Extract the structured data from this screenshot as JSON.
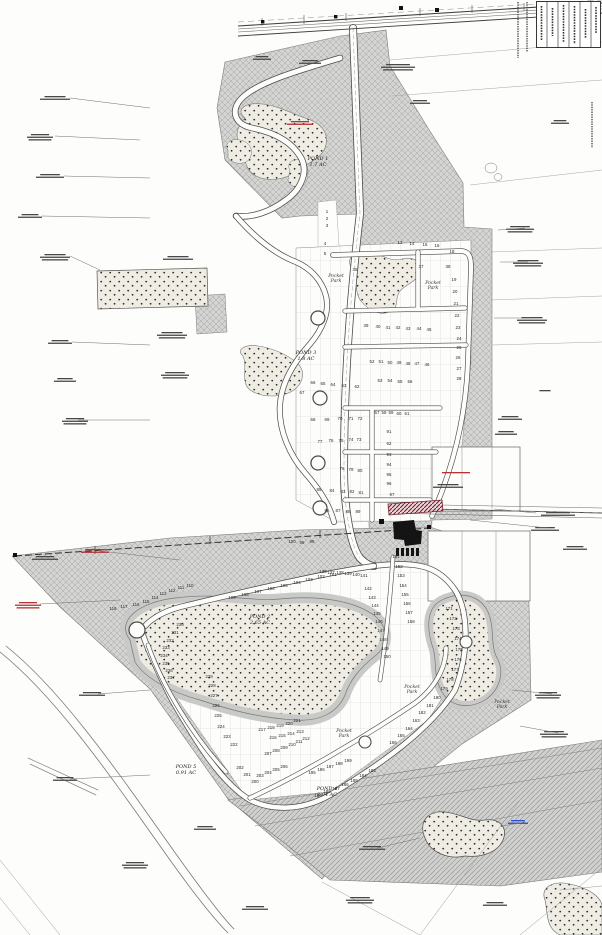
{
  "drawing": {
    "title": "Residential subdivision site plan",
    "ponds": [
      {
        "id": "pond1",
        "name": "POND 1",
        "area": "1.7 AC"
      },
      {
        "id": "pond3",
        "name": "POND 3",
        "area": "1.8 AC"
      },
      {
        "id": "pond2",
        "name": "POND 2",
        "area": "2.65 AC"
      },
      {
        "id": "pond5",
        "name": "POND 5",
        "area": "0.91 AC"
      },
      {
        "id": "pond4",
        "name": "POND 4",
        "area": "2.04 AC"
      }
    ],
    "park_label": "Pocket Park",
    "lots": [
      [
        1,
        327,
        213
      ],
      [
        2,
        327,
        220
      ],
      [
        3,
        327,
        227
      ],
      [
        4,
        325,
        245
      ],
      [
        5,
        325,
        255
      ],
      [
        13,
        400,
        244
      ],
      [
        14,
        412,
        245
      ],
      [
        15,
        425,
        246
      ],
      [
        16,
        437,
        247
      ],
      [
        18,
        452,
        253
      ],
      [
        19,
        454,
        281
      ],
      [
        20,
        455,
        293
      ],
      [
        21,
        456,
        305
      ],
      [
        22,
        457,
        317
      ],
      [
        23,
        458,
        329
      ],
      [
        24,
        459,
        340
      ],
      [
        25,
        459,
        349
      ],
      [
        26,
        458,
        359
      ],
      [
        27,
        459,
        370
      ],
      [
        28,
        459,
        380
      ],
      [
        35,
        355,
        271
      ],
      [
        37,
        421,
        268
      ],
      [
        38,
        448,
        268
      ],
      [
        39,
        366,
        327
      ],
      [
        40,
        378,
        328
      ],
      [
        41,
        388,
        329
      ],
      [
        42,
        398,
        329
      ],
      [
        43,
        408,
        330
      ],
      [
        44,
        419,
        330
      ],
      [
        45,
        429,
        331
      ],
      [
        46,
        427,
        366
      ],
      [
        47,
        417,
        365
      ],
      [
        48,
        408,
        365
      ],
      [
        49,
        399,
        364
      ],
      [
        50,
        390,
        364
      ],
      [
        51,
        381,
        363
      ],
      [
        52,
        372,
        363
      ],
      [
        53,
        380,
        382
      ],
      [
        54,
        390,
        382
      ],
      [
        55,
        400,
        383
      ],
      [
        56,
        410,
        383
      ],
      [
        62,
        357,
        388
      ],
      [
        63,
        344,
        387
      ],
      [
        64,
        333,
        386
      ],
      [
        65,
        323,
        385
      ],
      [
        66,
        313,
        384
      ],
      [
        67,
        302,
        394
      ],
      [
        68,
        313,
        421
      ],
      [
        69,
        327,
        421
      ],
      [
        70,
        340,
        420
      ],
      [
        71,
        351,
        420
      ],
      [
        72,
        360,
        420
      ],
      [
        73,
        359,
        441
      ],
      [
        74,
        351,
        441
      ],
      [
        75,
        341,
        442
      ],
      [
        76,
        331,
        442
      ],
      [
        77,
        320,
        443
      ],
      [
        57,
        377,
        414
      ],
      [
        58,
        384,
        414
      ],
      [
        59,
        391,
        414
      ],
      [
        60,
        399,
        415
      ],
      [
        61,
        407,
        415
      ],
      [
        78,
        342,
        470
      ],
      [
        79,
        351,
        471
      ],
      [
        80,
        360,
        472
      ],
      [
        81,
        361,
        494
      ],
      [
        82,
        352,
        493
      ],
      [
        83,
        343,
        493
      ],
      [
        84,
        332,
        492
      ],
      [
        85,
        319,
        491
      ],
      [
        86,
        327,
        512
      ],
      [
        87,
        338,
        512
      ],
      [
        88,
        348,
        513
      ],
      [
        89,
        358,
        513
      ],
      [
        91,
        389,
        433
      ],
      [
        92,
        389,
        445
      ],
      [
        93,
        389,
        456
      ],
      [
        94,
        389,
        466
      ],
      [
        95,
        389,
        476
      ],
      [
        96,
        389,
        485
      ],
      [
        97,
        392,
        496
      ],
      [
        98,
        312,
        543
      ],
      [
        99,
        302,
        544
      ],
      [
        100,
        292,
        543
      ],
      [
        101,
        333,
        576
      ],
      [
        102,
        321,
        578
      ],
      [
        103,
        309,
        581
      ],
      [
        104,
        297,
        584
      ],
      [
        105,
        284,
        587
      ],
      [
        106,
        271,
        590
      ],
      [
        107,
        258,
        593
      ],
      [
        108,
        245,
        596
      ],
      [
        109,
        232,
        599
      ],
      [
        110,
        190,
        587
      ],
      [
        111,
        181,
        589
      ],
      [
        112,
        172,
        592
      ],
      [
        113,
        163,
        595
      ],
      [
        114,
        155,
        599
      ],
      [
        115,
        146,
        603
      ],
      [
        116,
        136,
        606
      ],
      [
        117,
        124,
        608
      ],
      [
        118,
        113,
        610
      ],
      [
        136,
        323,
        573
      ],
      [
        137,
        331,
        574
      ],
      [
        138,
        340,
        574
      ],
      [
        139,
        348,
        575
      ],
      [
        140,
        356,
        576
      ],
      [
        141,
        364,
        577
      ],
      [
        142,
        368,
        590
      ],
      [
        143,
        372,
        599
      ],
      [
        144,
        375,
        607
      ],
      [
        145,
        377,
        615
      ],
      [
        146,
        379,
        623
      ],
      [
        147,
        381,
        632
      ],
      [
        148,
        383,
        641
      ],
      [
        149,
        385,
        650
      ],
      [
        150,
        387,
        658
      ],
      [
        151,
        396,
        558
      ],
      [
        152,
        399,
        568
      ],
      [
        153,
        401,
        577
      ],
      [
        154,
        403,
        587
      ],
      [
        155,
        405,
        596
      ],
      [
        156,
        407,
        605
      ],
      [
        157,
        409,
        614
      ],
      [
        158,
        411,
        623
      ],
      [
        171,
        449,
        610
      ],
      [
        172,
        453,
        620
      ],
      [
        173,
        456,
        630
      ],
      [
        174,
        458,
        640
      ],
      [
        175,
        459,
        651
      ],
      [
        176,
        458,
        661
      ],
      [
        177,
        455,
        671
      ],
      [
        178,
        450,
        681
      ],
      [
        179,
        444,
        690
      ],
      [
        180,
        437,
        699
      ],
      [
        181,
        430,
        707
      ],
      [
        182,
        422,
        714
      ],
      [
        163,
        416,
        722
      ],
      [
        164,
        409,
        730
      ],
      [
        165,
        401,
        737
      ],
      [
        166,
        393,
        744
      ],
      [
        183,
        372,
        772
      ],
      [
        184,
        363,
        777
      ],
      [
        185,
        354,
        782
      ],
      [
        186,
        345,
        786
      ],
      [
        187,
        336,
        790
      ],
      [
        188,
        327,
        793
      ],
      [
        189,
        318,
        797
      ],
      [
        195,
        312,
        774
      ],
      [
        196,
        321,
        771
      ],
      [
        197,
        330,
        768
      ],
      [
        198,
        339,
        765
      ],
      [
        199,
        348,
        762
      ],
      [
        200,
        255,
        783
      ],
      [
        201,
        247,
        776
      ],
      [
        202,
        240,
        769
      ],
      [
        203,
        260,
        777
      ],
      [
        204,
        268,
        774
      ],
      [
        205,
        276,
        771
      ],
      [
        206,
        284,
        768
      ],
      [
        207,
        268,
        755
      ],
      [
        208,
        276,
        752
      ],
      [
        209,
        284,
        749
      ],
      [
        210,
        292,
        746
      ],
      [
        211,
        299,
        743
      ],
      [
        212,
        306,
        740
      ],
      [
        213,
        300,
        733
      ],
      [
        214,
        291,
        735
      ],
      [
        215,
        282,
        737
      ],
      [
        216,
        273,
        739
      ],
      [
        217,
        262,
        731
      ],
      [
        218,
        271,
        729
      ],
      [
        219,
        280,
        727
      ],
      [
        220,
        289,
        725
      ],
      [
        221,
        297,
        722
      ],
      [
        222,
        234,
        746
      ],
      [
        223,
        227,
        738
      ],
      [
        224,
        221,
        728
      ],
      [
        225,
        218,
        717
      ],
      [
        226,
        216,
        707
      ],
      [
        227,
        214,
        697
      ],
      [
        228,
        212,
        687
      ],
      [
        229,
        209,
        678
      ],
      [
        230,
        180,
        626
      ],
      [
        231,
        175,
        634
      ],
      [
        232,
        170,
        642
      ],
      [
        233,
        166,
        649
      ],
      [
        234,
        164,
        657
      ],
      [
        235,
        166,
        665
      ],
      [
        236,
        169,
        672
      ],
      [
        237,
        171,
        679
      ]
    ]
  },
  "colors": {
    "hatch_gray": "#d2d2d2",
    "hatch_line": "#9e9e9e",
    "ink": "#3a3a3a",
    "accent_maroon": "#7a2230",
    "accent_red": "#b23434",
    "accent_blue": "#2a4fd0"
  }
}
